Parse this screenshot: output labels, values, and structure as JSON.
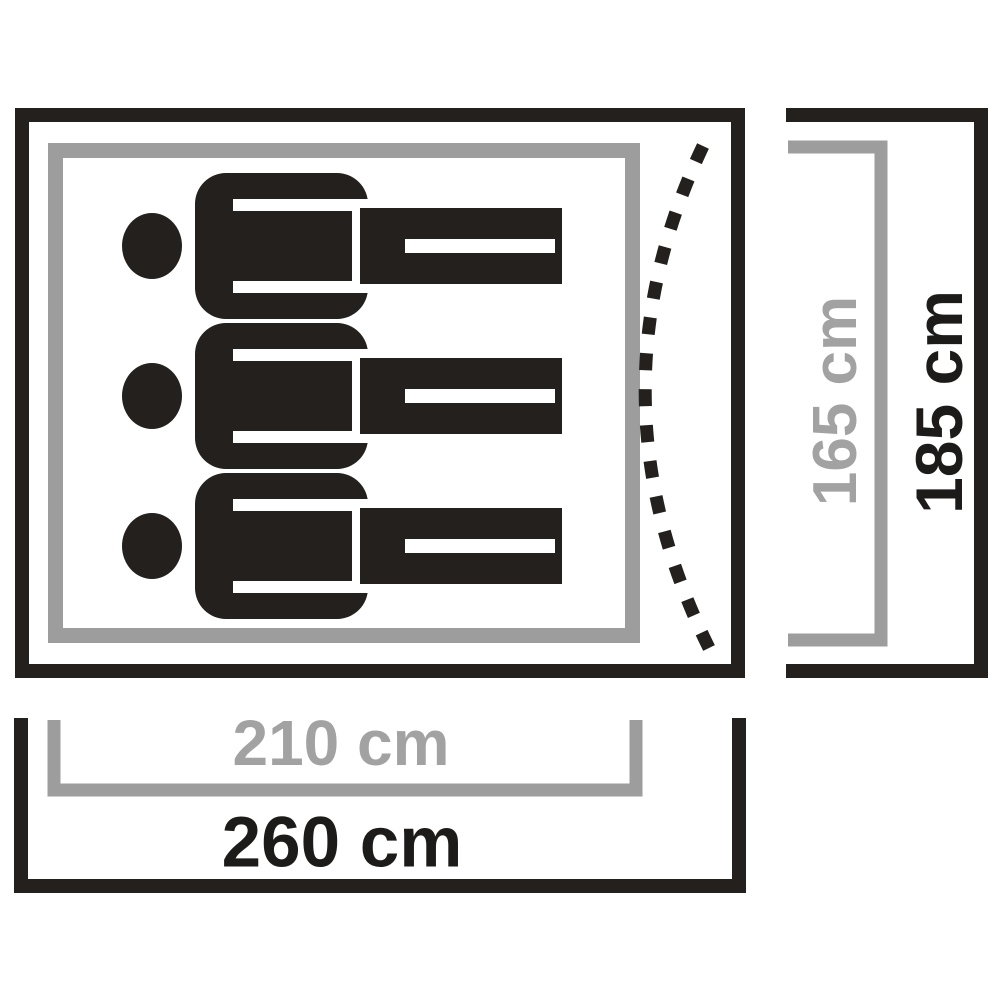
{
  "diagram": {
    "kind": "tent-floorplan-top-view",
    "person_count": 3,
    "colors": {
      "outline_black": "#23201d",
      "outline_gray": "#9d9d9d",
      "label_gray": "#a2a2a2",
      "label_black": "#1d1b1a",
      "background": "#ffffff"
    },
    "icons": {
      "person": "person-lying-icon",
      "door": "dashed-door-curve-icon"
    },
    "dimensions": {
      "inner_width": "210 cm",
      "outer_width": "260 cm",
      "inner_depth": "165 cm",
      "outer_depth": "185 cm"
    }
  }
}
